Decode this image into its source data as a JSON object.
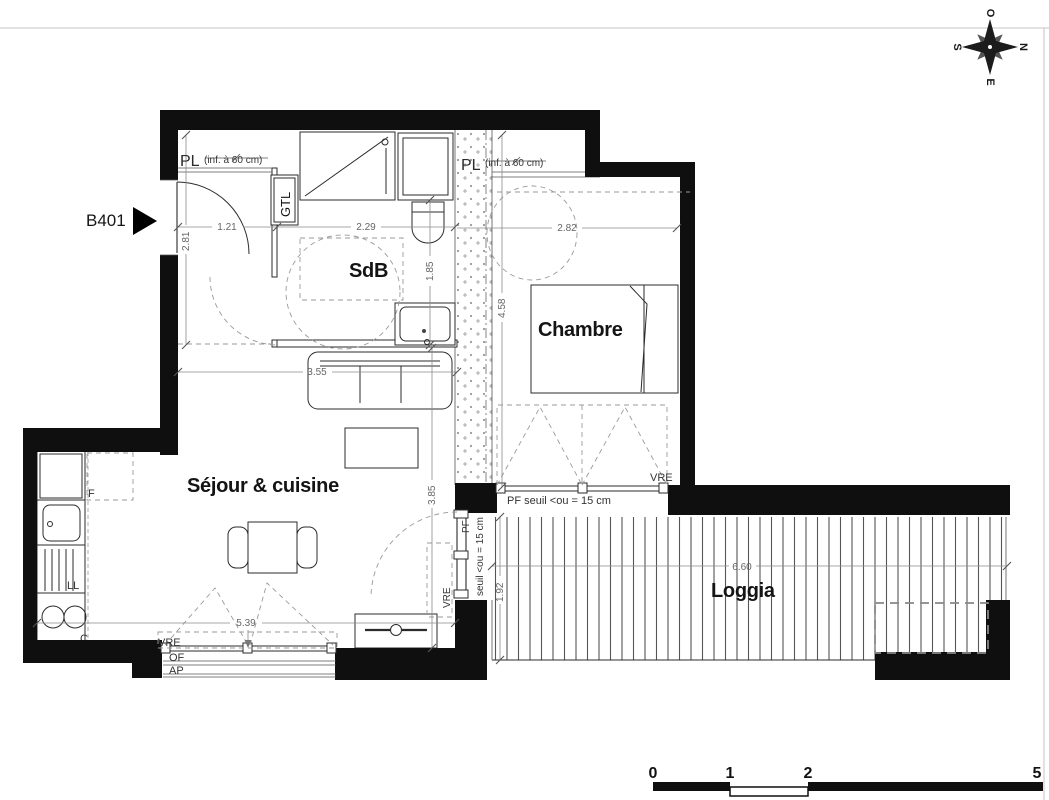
{
  "unit": {
    "label": "B401"
  },
  "rooms": {
    "sdb": "SdB",
    "chambre": "Chambre",
    "sejour": "Séjour & cuisine",
    "loggia": "Loggia"
  },
  "storage": {
    "pl": "PL",
    "pl_note": "(inf. à 60 cm)",
    "gtl": "GTL"
  },
  "kitchen": {
    "fridge": "F",
    "washer": "LL",
    "cooktop": "C"
  },
  "openings": {
    "vre": "VRE",
    "of": "OF",
    "ap": "AP",
    "pf": "PF",
    "pf_seuil": "PF seuil <ou = 15 cm",
    "seuil": "seuil <ou = 15 cm"
  },
  "dims": {
    "entry_w": "1.21",
    "entry_d": "2.81",
    "sdb_w": "2.29",
    "sdb_d": "1.85",
    "chambre_w": "2.82",
    "chambre_d": "4.58",
    "sejour_w": "3.55",
    "sejour_d": "3.85",
    "facade_w": "5.39",
    "loggia_w": "6.60",
    "loggia_d": "1.92"
  },
  "compass": {
    "n": "N",
    "e": "E",
    "s": "S",
    "w": "O"
  },
  "scale_bar": {
    "ticks": [
      "0",
      "1",
      "2",
      "5"
    ]
  },
  "colors": {
    "ink": "#0f0f0f",
    "dim_text": "#666666",
    "dashed": "#9a9a9a"
  }
}
